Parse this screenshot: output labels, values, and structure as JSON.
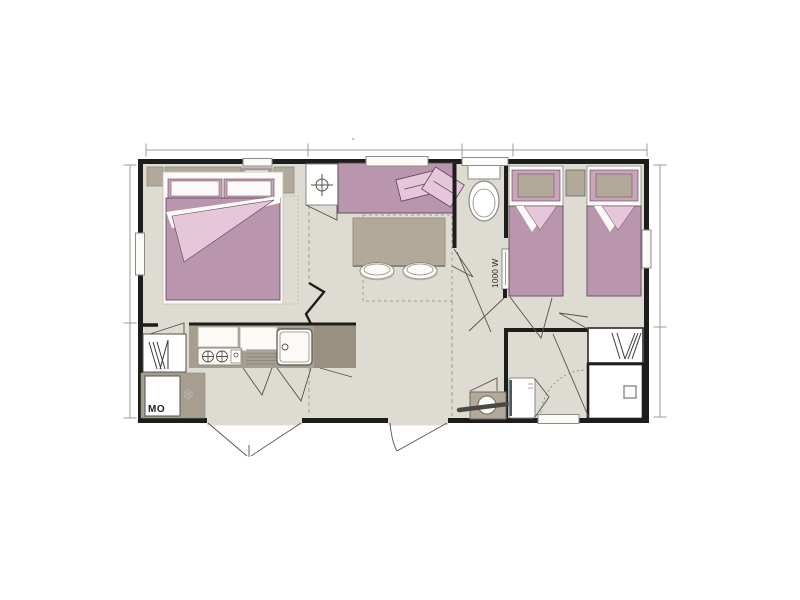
{
  "canvas": {
    "background": "#ffffff"
  },
  "floorplan": {
    "kind": "mobile-home-floor-plan",
    "labels": {
      "microwave": "MO",
      "heater_wattage": "1000 W"
    },
    "icons": {
      "freezer_snowflake": "❄",
      "utility_cross": "circle-crosshair",
      "wardrobe_clothes": "diagonal-hanging-lines",
      "hob_burners": "two-cross-burners"
    },
    "colors": {
      "wall": "#1d1d1b",
      "floor": "#dedbd2",
      "mauve": "#b996ad",
      "mauve_light": "#c8a5bb",
      "pink_light": "#e6c6d9",
      "taupe": "#b3a99b",
      "counter": "#a89e8f",
      "counter_shadow": "#9a9081",
      "white_fixture": "#fbfaf7",
      "outline_gray": "#8a8a86",
      "outline_plum": "#5e4256",
      "dimension_gray": "#9b9b97",
      "door_line": "#55524c",
      "dash_gray": "#a29e93",
      "teal_strip": "#3e5f6b",
      "snowflake_gray": "#b6b0a5",
      "towel_bar": "#4a4843"
    }
  }
}
